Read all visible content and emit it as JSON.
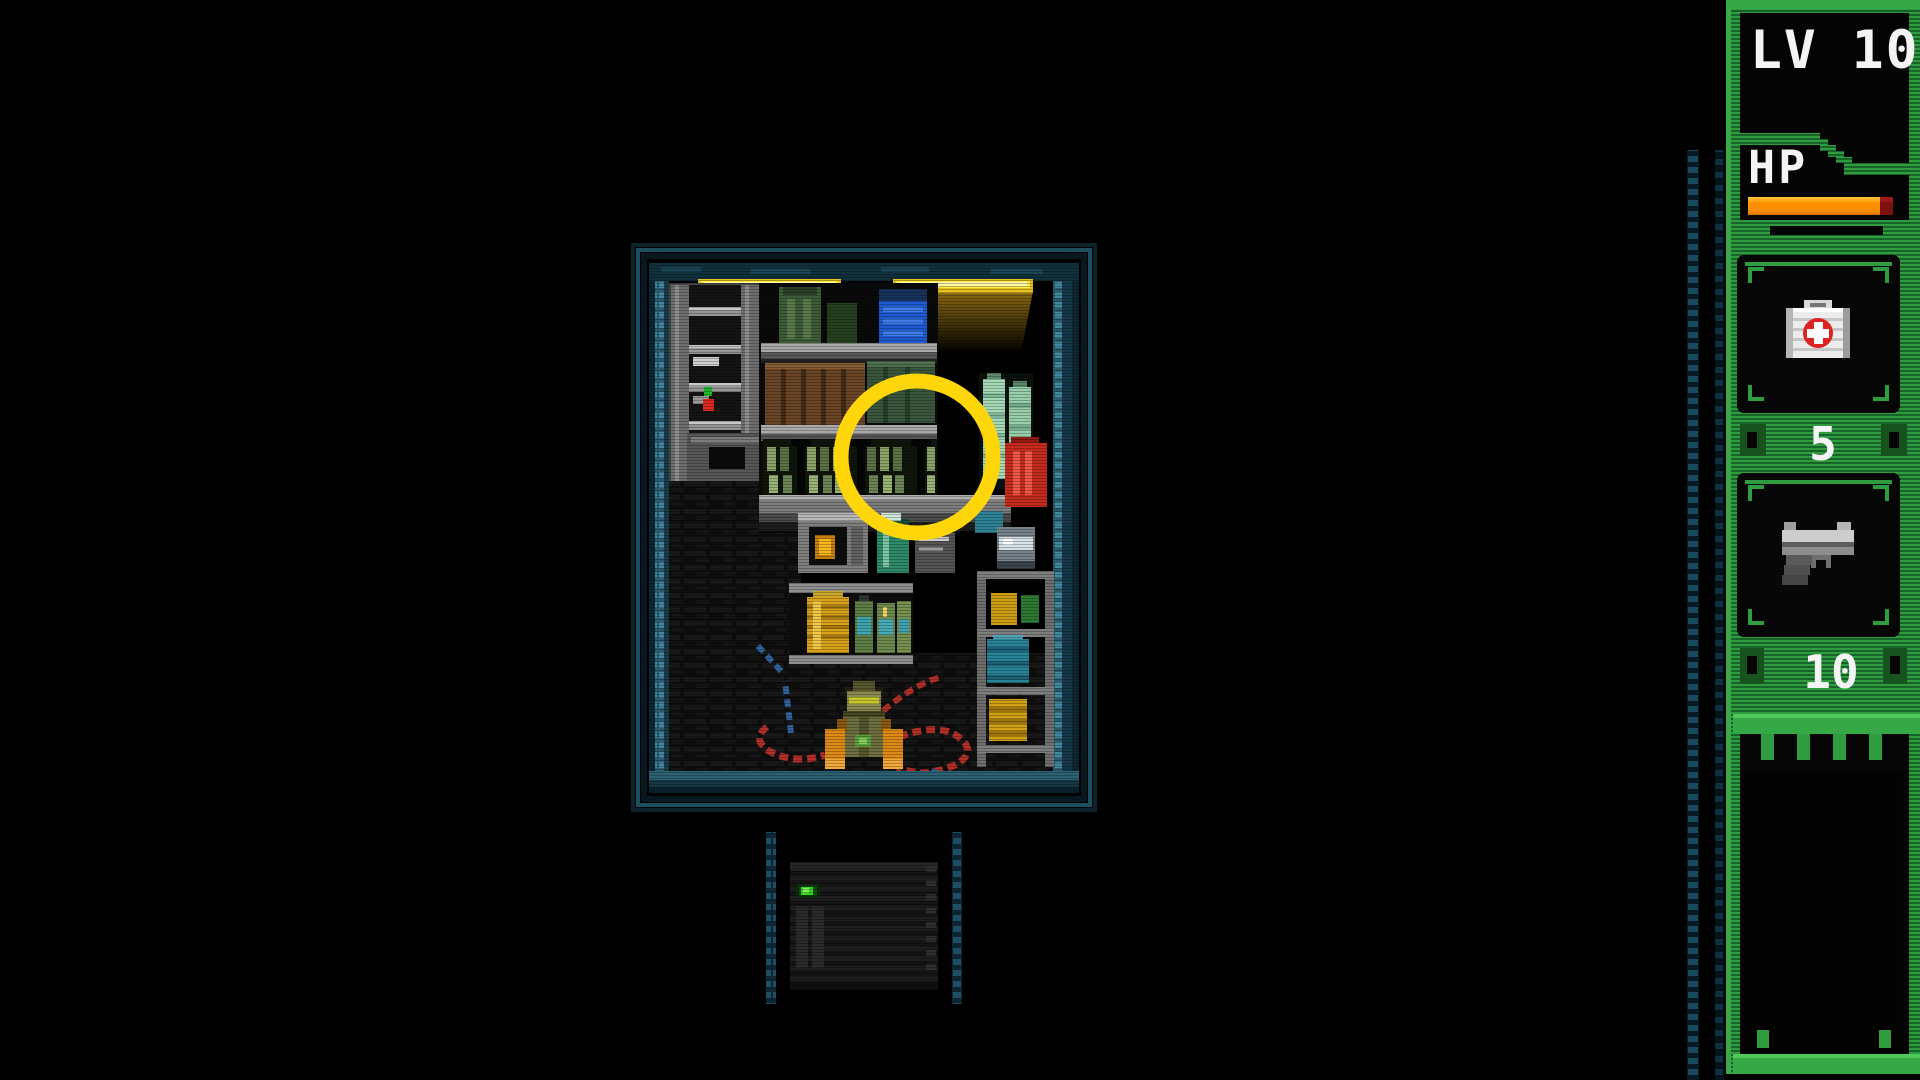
{
  "hud": {
    "level": {
      "label": "LV",
      "value": "10",
      "text": "LV 10"
    },
    "hp": {
      "label": "HP",
      "percent_estimate": 91,
      "bar_width_px": "132",
      "bar_color": "#ff9200",
      "damage_color": "#7e1010"
    },
    "slots": [
      {
        "id": "medkit",
        "icon": "medkit-icon",
        "count": "5"
      },
      {
        "id": "pistol",
        "icon": "pistol-icon",
        "count": "10"
      }
    ]
  },
  "scene": {
    "room": {
      "name": "storage-room"
    },
    "highlight": {
      "type": "circle",
      "color": "#ffd60a"
    },
    "objects": [
      "ceiling-lights",
      "left-locker",
      "supply-shelves",
      "green-bottles",
      "blue-box",
      "red-canister",
      "mint-bottles",
      "microwave",
      "yellow-jar",
      "teal-barrel",
      "yellow-barrel",
      "technician-with-cables",
      "dark-floor",
      "server-unit"
    ]
  },
  "colors": {
    "background": "#000000",
    "hud_green": "#2f9c40",
    "hud_green_dark": "#18632a",
    "accent_green_bright": "#45c653",
    "teal_wall": "#357084",
    "light_bar": "#ffec4a",
    "highlight_yellow": "#ffd60a"
  }
}
